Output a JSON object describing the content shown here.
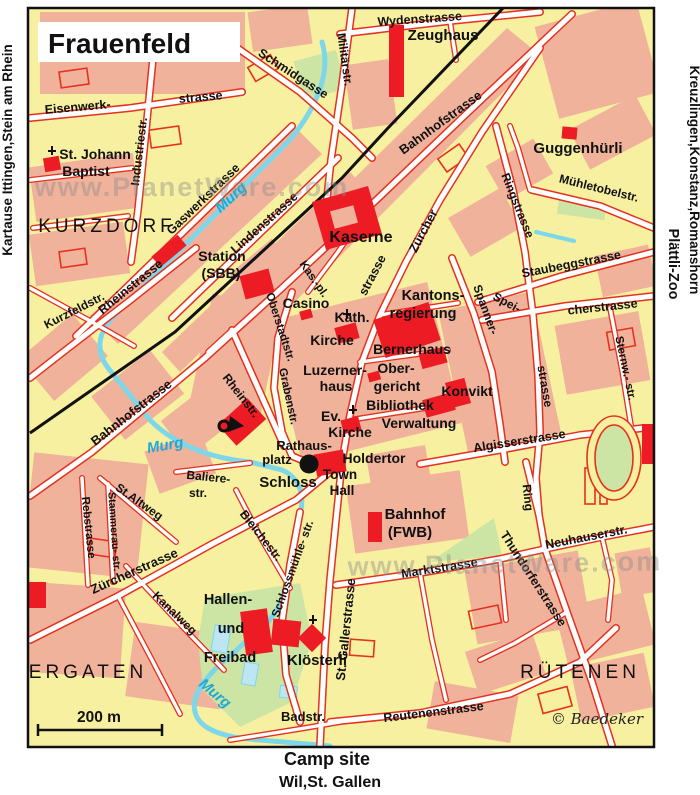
{
  "map": {
    "title": "Frauenfeld",
    "scale_label": "200 m",
    "copyright": "© Baedeker",
    "watermark": "www.PlanetWare.com",
    "colors": {
      "background_block": "#F7F0A0",
      "builtup_block": "#F0B29B",
      "street_casing_red": "#E5311F",
      "landmark_building_red": "#EC1B24",
      "river_cyan": "#82D8E8",
      "park_green": "#CDE5A4",
      "railway_black": "#111111",
      "highlight_magenta": "#EB1E6E",
      "watermark_gray": "#8E8E8E"
    },
    "icons": [
      {
        "n": "info-icon",
        "type": "info",
        "glyph": "i",
        "x": 309,
        "y": 464
      },
      {
        "n": "posthorn-icon",
        "type": "posthorn",
        "x": 228,
        "y": 424
      },
      {
        "n": "church-cross-icon",
        "type": "cross",
        "x": 52,
        "y": 151
      },
      {
        "n": "church-cross-icon",
        "type": "cross",
        "x": 347,
        "y": 314
      },
      {
        "n": "church-cross-icon",
        "type": "cross",
        "x": 353,
        "y": 410
      },
      {
        "n": "church-cross-icon",
        "type": "cross",
        "x": 313,
        "y": 620
      }
    ],
    "labels": [
      {
        "n": "edge-left-destinations",
        "t": "Kartause Ittingen,Stein am Rhein",
        "x": 12,
        "y": 150,
        "r": -90,
        "s": 13.5,
        "k": "edge"
      },
      {
        "n": "edge-right-destinations",
        "t": "Kreuzlingen,Konstanz,Romanshorn",
        "x": 690,
        "y": 180,
        "r": 90,
        "s": 13.5,
        "k": "edge"
      },
      {
        "n": "edge-right-zoo",
        "t": "Plättli-Zoo",
        "x": 669,
        "y": 264,
        "r": 90,
        "s": 14.5,
        "k": "zoo"
      },
      {
        "n": "camp-site-label",
        "t": "Camp site",
        "x": 327,
        "y": 765,
        "s": 18,
        "k": "camp"
      },
      {
        "n": "destination-south",
        "t": "Wil,St. Gallen",
        "x": 330,
        "y": 787,
        "s": 16,
        "k": "dest"
      },
      {
        "n": "street-wydenstrasse",
        "t": "Wydenstrasse",
        "x": 420,
        "y": 23,
        "r": -4,
        "s": 12.5,
        "k": "street"
      },
      {
        "n": "poi-zeughaus",
        "t": "Zeughaus",
        "x": 443,
        "y": 40,
        "s": 15,
        "k": "poi"
      },
      {
        "n": "street-militaerstr",
        "t": "Militärstr.",
        "x": 341,
        "y": 60,
        "r": 82,
        "s": 12,
        "k": "street"
      },
      {
        "n": "street-schmidgasse",
        "t": "Schmidgasse",
        "x": 291,
        "y": 77,
        "r": 33,
        "s": 12.5,
        "k": "street"
      },
      {
        "n": "street-eisenwerk",
        "t": "Eisenwerk-",
        "x": 78,
        "y": 111,
        "r": -5,
        "s": 12.5,
        "k": "street"
      },
      {
        "n": "street-eisenwerk-2",
        "t": "strasse",
        "x": 201,
        "y": 101,
        "r": -5,
        "s": 12.5,
        "k": "street"
      },
      {
        "n": "street-industriestr",
        "t": "Industriestr.",
        "x": 143,
        "y": 152,
        "r": -83,
        "s": 12,
        "k": "street"
      },
      {
        "n": "street-bahnhofstrasse-ne",
        "t": "Bahnhofstrasse",
        "x": 443,
        "y": 126,
        "r": -36,
        "s": 13,
        "k": "street"
      },
      {
        "n": "poi-st-johann",
        "t": "St. Johann",
        "x": 95,
        "y": 159,
        "s": 14,
        "k": "poi"
      },
      {
        "n": "poi-st-johann-2",
        "t": "Baptist",
        "x": 86,
        "y": 176,
        "s": 14,
        "k": "poi"
      },
      {
        "n": "poi-guggenhuerli",
        "t": "Guggenhürli",
        "x": 578,
        "y": 153,
        "s": 15,
        "k": "poi"
      },
      {
        "n": "street-muehletobelstr",
        "t": "Mühletobelstr.",
        "x": 598,
        "y": 192,
        "r": 14,
        "s": 12,
        "k": "street"
      },
      {
        "n": "street-ringstrasse",
        "t": "Ringstrasse",
        "x": 514,
        "y": 207,
        "r": 68,
        "s": 12,
        "k": "street"
      },
      {
        "n": "street-staubeggstrasse",
        "t": "Staubeggstrasse",
        "x": 572,
        "y": 268,
        "r": -11,
        "s": 12.5,
        "k": "street"
      },
      {
        "n": "street-speicherstrasse-1",
        "t": "Spei-",
        "x": 505,
        "y": 306,
        "r": 28,
        "s": 12,
        "k": "street"
      },
      {
        "n": "street-speicherstrasse-2",
        "t": "cherstrasse",
        "x": 603,
        "y": 311,
        "r": -6,
        "s": 12.5,
        "k": "street"
      },
      {
        "n": "street-spannerstrasse-1",
        "t": "Spanner-",
        "x": 482,
        "y": 311,
        "r": 70,
        "s": 12,
        "k": "street"
      },
      {
        "n": "street-spannerstrasse-2",
        "t": "strasse",
        "x": 541,
        "y": 387,
        "r": 80,
        "s": 12,
        "k": "street"
      },
      {
        "n": "street-sternwartstr",
        "t": "Sternw.- str.",
        "x": 622,
        "y": 369,
        "r": 78,
        "s": 11.5,
        "k": "street"
      },
      {
        "n": "area-kurzdorf",
        "t": "KURZDORF",
        "x": 107,
        "y": 232,
        "s": 19,
        "k": "area"
      },
      {
        "n": "street-gaswerkstrasse",
        "t": "Gaswerkstrasse",
        "x": 206,
        "y": 202,
        "r": -44,
        "s": 12.5,
        "k": "street"
      },
      {
        "n": "street-lindenstrasse",
        "t": "Lindenstrasse",
        "x": 267,
        "y": 226,
        "r": -42,
        "s": 12.5,
        "k": "street"
      },
      {
        "n": "river-murg-1",
        "t": "Murg",
        "x": 234,
        "y": 201,
        "r": -42,
        "s": 15,
        "k": "river"
      },
      {
        "n": "street-rheinstrasse",
        "t": "Rheinstrasse",
        "x": 133,
        "y": 290,
        "r": -39,
        "s": 12.5,
        "k": "street"
      },
      {
        "n": "street-kurzfeldstr",
        "t": "Kurzfeldstr.",
        "x": 76,
        "y": 314,
        "r": -27,
        "s": 12,
        "k": "street"
      },
      {
        "n": "poi-station-sbb",
        "t": "Station",
        "x": 222,
        "y": 261,
        "s": 14,
        "k": "poi"
      },
      {
        "n": "poi-station-sbb-2",
        "t": "(SBB)",
        "x": 221,
        "y": 278,
        "s": 14,
        "k": "poi"
      },
      {
        "n": "street-kasernenplatz",
        "t": "Kas.-pl.",
        "x": 311,
        "y": 281,
        "r": 55,
        "s": 11.5,
        "k": "street"
      },
      {
        "n": "street-oberstadtstr",
        "t": "Oberstadtstr.",
        "x": 277,
        "y": 328,
        "r": 72,
        "s": 11.5,
        "k": "street"
      },
      {
        "n": "street-grabenstr",
        "t": "Grabenstr.",
        "x": 285,
        "y": 397,
        "r": 78,
        "s": 11.5,
        "k": "street"
      },
      {
        "n": "poi-kaserne",
        "t": "Kaserne",
        "x": 361,
        "y": 242,
        "s": 16,
        "k": "poi"
      },
      {
        "n": "street-zuercherstrasse-n1",
        "t": "Zürcher",
        "x": 427,
        "y": 233,
        "r": -62,
        "s": 12.5,
        "k": "street"
      },
      {
        "n": "street-zuercherstrasse-n2",
        "t": "strasse",
        "x": 376,
        "y": 277,
        "r": -62,
        "s": 12.5,
        "k": "street"
      },
      {
        "n": "poi-casino",
        "t": "Casino",
        "x": 306,
        "y": 308,
        "s": 14,
        "k": "poi"
      },
      {
        "n": "poi-kath-kirche-1",
        "t": "Kath.",
        "x": 352,
        "y": 322,
        "s": 14,
        "k": "poi"
      },
      {
        "n": "poi-kath-kirche-2",
        "t": "Kirche",
        "x": 332,
        "y": 345,
        "s": 14,
        "k": "poi"
      },
      {
        "n": "poi-kantonsregierung-1",
        "t": "Kantons-",
        "x": 433,
        "y": 300,
        "s": 14.5,
        "k": "poi"
      },
      {
        "n": "poi-kantonsregierung-2",
        "t": "regierung",
        "x": 423,
        "y": 318,
        "s": 14.5,
        "k": "poi"
      },
      {
        "n": "poi-bernerhaus",
        "t": "Bernerhaus",
        "x": 412,
        "y": 354,
        "s": 14,
        "k": "poi"
      },
      {
        "n": "poi-luzernerhaus-1",
        "t": "Luzerner-",
        "x": 335,
        "y": 375,
        "s": 14,
        "k": "poi"
      },
      {
        "n": "poi-luzernerhaus-2",
        "t": "haus",
        "x": 336,
        "y": 391,
        "s": 14,
        "k": "poi"
      },
      {
        "n": "poi-obergericht-1",
        "t": "Ober-",
        "x": 396,
        "y": 373,
        "s": 14,
        "k": "poi"
      },
      {
        "n": "poi-obergericht-2",
        "t": "gericht",
        "x": 397,
        "y": 391,
        "s": 14,
        "k": "poi"
      },
      {
        "n": "poi-konvikt",
        "t": "Konvikt",
        "x": 467,
        "y": 396,
        "s": 14,
        "k": "poi"
      },
      {
        "n": "poi-bibliothek",
        "t": "Bibliothek",
        "x": 400,
        "y": 410,
        "s": 14,
        "k": "poi"
      },
      {
        "n": "poi-verwaltung",
        "t": "Verwaltung",
        "x": 419,
        "y": 428,
        "s": 14,
        "k": "poi"
      },
      {
        "n": "poi-ev-kirche-1",
        "t": "Ev.",
        "x": 331,
        "y": 421,
        "s": 14,
        "k": "poi"
      },
      {
        "n": "poi-ev-kirche-2",
        "t": "Kirche",
        "x": 350,
        "y": 437,
        "s": 14,
        "k": "poi"
      },
      {
        "n": "street-bahnhofstrasse-sw",
        "t": "Bahnhofstrasse",
        "x": 134,
        "y": 416,
        "r": -38,
        "s": 13,
        "k": "street"
      },
      {
        "n": "river-murg-2",
        "t": "Murg",
        "x": 166,
        "y": 450,
        "r": -10,
        "s": 15,
        "k": "river"
      },
      {
        "n": "poi-rathausplatz-1",
        "t": "Rathaus-",
        "x": 304,
        "y": 450,
        "s": 13,
        "k": "poi"
      },
      {
        "n": "poi-rathausplatz-2",
        "t": "platz",
        "x": 277,
        "y": 464,
        "s": 13,
        "k": "poi"
      },
      {
        "n": "poi-holdertor",
        "t": "Holdertor",
        "x": 374,
        "y": 463,
        "s": 14,
        "k": "poi"
      },
      {
        "n": "poi-schloss",
        "t": "Schloss",
        "x": 288,
        "y": 487,
        "s": 15,
        "k": "poi"
      },
      {
        "n": "poi-town-hall-1",
        "t": "Town",
        "x": 340,
        "y": 479,
        "s": 13.5,
        "k": "poi"
      },
      {
        "n": "poi-town-hall-2",
        "t": "Hall",
        "x": 342,
        "y": 495,
        "s": 13.5,
        "k": "poi"
      },
      {
        "n": "street-balierestr-1",
        "t": "Baliere-",
        "x": 208,
        "y": 481,
        "r": 6,
        "s": 12,
        "k": "street"
      },
      {
        "n": "street-balierestr-2",
        "t": "str.",
        "x": 198,
        "y": 497,
        "s": 12,
        "k": "street"
      },
      {
        "n": "street-rheinstr-s",
        "t": "Rheinstr.",
        "x": 238,
        "y": 398,
        "r": 52,
        "s": 12,
        "k": "street"
      },
      {
        "n": "street-bleichestr",
        "t": "Bleichestr.",
        "x": 258,
        "y": 538,
        "r": 52,
        "s": 12,
        "k": "street"
      },
      {
        "n": "street-schlossmuehlestr",
        "t": "Schlossmühle- str.",
        "x": 296,
        "y": 570,
        "r": -70,
        "s": 11.5,
        "k": "street"
      },
      {
        "n": "street-st-altweg",
        "t": "St.Altweg",
        "x": 137,
        "y": 505,
        "r": 35,
        "s": 12,
        "k": "street"
      },
      {
        "n": "street-rebstrasse",
        "t": "Rebstrasse",
        "x": 85,
        "y": 528,
        "r": 84,
        "s": 11.5,
        "k": "street"
      },
      {
        "n": "street-stammeraustr",
        "t": "Stammerau- str.",
        "x": 111,
        "y": 532,
        "r": 86,
        "s": 10.5,
        "k": "street"
      },
      {
        "n": "street-zuercherstrasse-sw",
        "t": "Zürcherstrasse",
        "x": 136,
        "y": 575,
        "r": -24,
        "s": 13,
        "k": "street"
      },
      {
        "n": "street-kanalweg",
        "t": "Kanalweg",
        "x": 172,
        "y": 616,
        "r": 44,
        "s": 12,
        "k": "street"
      },
      {
        "n": "area-ergaten",
        "t": "ERGATEN",
        "x": 88,
        "y": 678,
        "s": 19,
        "k": "area"
      },
      {
        "n": "poi-freibad-1",
        "t": "Hallen-",
        "x": 228,
        "y": 604,
        "s": 14.5,
        "k": "poi"
      },
      {
        "n": "poi-freibad-2",
        "t": "und",
        "x": 231,
        "y": 633,
        "s": 14.5,
        "k": "poi"
      },
      {
        "n": "poi-freibad-3",
        "t": "Freibad",
        "x": 230,
        "y": 662,
        "s": 14.5,
        "k": "poi"
      },
      {
        "n": "river-murg-3",
        "t": "Murg",
        "x": 212,
        "y": 697,
        "r": 40,
        "s": 15,
        "k": "river"
      },
      {
        "n": "poi-kloesterli",
        "t": "Klösterli",
        "x": 317,
        "y": 665,
        "s": 15,
        "k": "poi"
      },
      {
        "n": "street-badstr",
        "t": "Badstr.",
        "x": 303,
        "y": 721,
        "s": 13,
        "k": "street"
      },
      {
        "n": "street-st-gallerstrasse",
        "t": "St. Gallerstrasse",
        "x": 350,
        "y": 630,
        "r": -84,
        "s": 13,
        "k": "street"
      },
      {
        "n": "street-reutenenstrasse",
        "t": "Reutenenstrasse",
        "x": 434,
        "y": 716,
        "r": -7,
        "s": 12.5,
        "k": "street"
      },
      {
        "n": "street-marktstrasse",
        "t": "Marktstrasse",
        "x": 440,
        "y": 572,
        "r": -9,
        "s": 12.5,
        "k": "street"
      },
      {
        "n": "poi-bahnhof-fwb-1",
        "t": "Bahnhof",
        "x": 415,
        "y": 519,
        "s": 15,
        "k": "poi"
      },
      {
        "n": "poi-bahnhof-fwb-2",
        "t": "(FWB)",
        "x": 410,
        "y": 537,
        "s": 15,
        "k": "poi"
      },
      {
        "n": "street-thundorferstrasse",
        "t": "Thundorferstrasse",
        "x": 530,
        "y": 581,
        "r": 57,
        "s": 12.5,
        "k": "street"
      },
      {
        "n": "street-neuhauserstr",
        "t": "Neuhauserstr.",
        "x": 587,
        "y": 541,
        "r": -11,
        "s": 12.5,
        "k": "street"
      },
      {
        "n": "street-ring",
        "t": "Ring",
        "x": 524,
        "y": 498,
        "r": 84,
        "s": 12,
        "k": "street"
      },
      {
        "n": "street-algisserstrasse",
        "t": "Algisserstrasse",
        "x": 520,
        "y": 445,
        "r": -9,
        "s": 12.5,
        "k": "street"
      },
      {
        "n": "area-ruetenen",
        "t": "RÜTENEN",
        "x": 580,
        "y": 678,
        "s": 19,
        "k": "area"
      },
      {
        "n": "copyright-baedeker",
        "t": "© Baedeker",
        "x": 597,
        "y": 724,
        "s": 15,
        "k": "note"
      },
      {
        "n": "watermark-1",
        "t": "www.PlanetWare.com",
        "x": 192,
        "y": 196,
        "s": 27,
        "k": "wm"
      },
      {
        "n": "watermark-2",
        "t": "www.PlanetWare.com",
        "x": 505,
        "y": 573,
        "r": -1,
        "s": 27,
        "k": "wm"
      }
    ]
  }
}
